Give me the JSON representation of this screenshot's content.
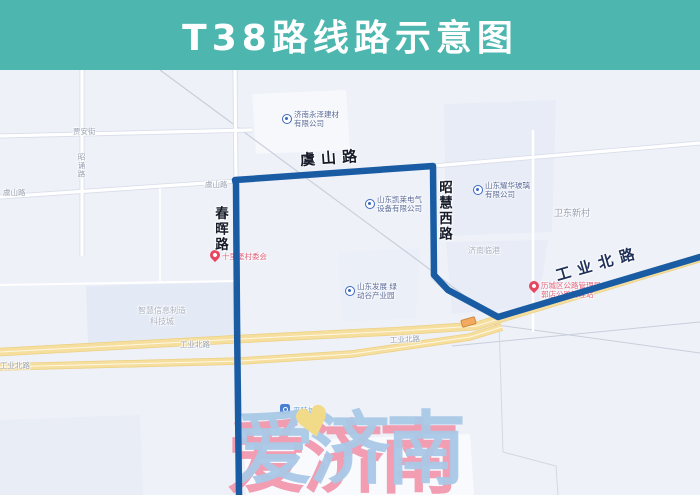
{
  "header": {
    "title": "T38路线路示意图"
  },
  "colors": {
    "header_bg": "#4cb6af",
    "route_blue": "#1a5ca3",
    "highway_yellow": "#f6df9e",
    "watermark_blue": "#a9c9e7",
    "watermark_pink": "#f187a0",
    "heart_yellow": "#f1db88"
  },
  "map": {
    "major_road_labels": {
      "yushan": "虞山路",
      "chunhui": "春晖路",
      "zhaohui_west": "昭慧西路",
      "gongye_north": "工业北路"
    },
    "minor_road_labels": [
      {
        "text": "贾安街"
      },
      {
        "text": "昭诵路"
      },
      {
        "text": "虞山路"
      },
      {
        "text": "虞山路"
      },
      {
        "text": "工业北路"
      },
      {
        "text": "工业北路"
      },
      {
        "text": "工业北路"
      }
    ],
    "area_labels": [
      {
        "text": "卫东新村"
      },
      {
        "text": "济南临港"
      },
      {
        "text": "智慧信息制造"
      },
      {
        "text": "科技城"
      }
    ],
    "company_pois": [
      {
        "line1": "济南永泽建材",
        "line2": "有限公司"
      },
      {
        "line1": "山东凯莱电气",
        "line2": "设备有限公司"
      },
      {
        "line1": "山东耀华玻璃",
        "line2": "有限公司"
      },
      {
        "line1": "山东发展 绿",
        "line2": "动谷产业园"
      }
    ],
    "red_pois": [
      {
        "line1": "十里堡村委会",
        "line2": ""
      },
      {
        "line1": "历城区公路管理局",
        "line2": "郭店公路管理站"
      }
    ],
    "station": {
      "label": "平陵城站"
    },
    "watermark": {
      "text": "爱济南"
    }
  }
}
